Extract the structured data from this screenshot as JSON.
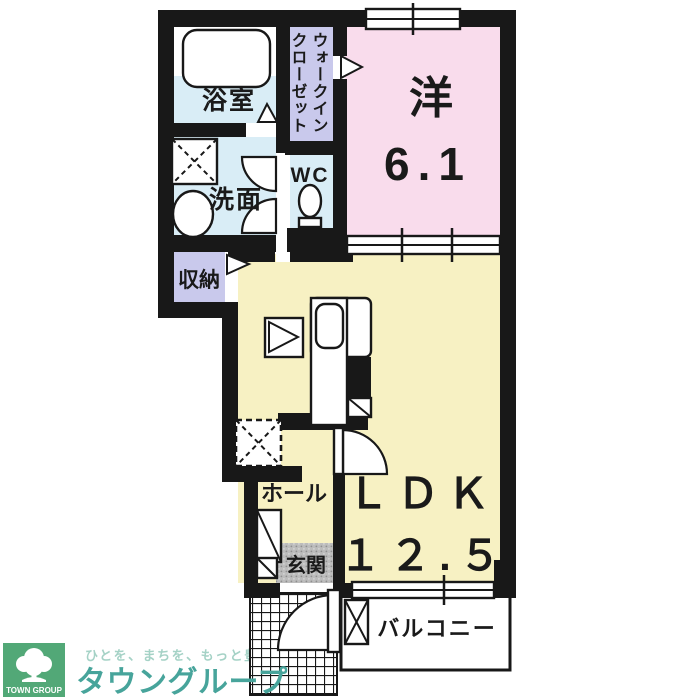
{
  "floorplan": {
    "western_room": {
      "name": "洋",
      "size": "6.1"
    },
    "ldk": {
      "name": "ＬＤＫ",
      "size": "１２.５"
    },
    "bathroom": "浴室",
    "washroom": "洗面",
    "toilet": "WC",
    "walk_in_closet": {
      "line1": "ウォークイン",
      "line2": "クローゼット"
    },
    "storage": "収納",
    "hall": "ホール",
    "entrance": "玄関",
    "balcony": "バルコニー"
  },
  "branding": {
    "logo_text": "TOWN GROUP",
    "tagline": "ひとを、まちを、もっと豊かに",
    "company": "タウングループ"
  },
  "colors": {
    "wall": "#181818",
    "western_room_fill": "#f9dcec",
    "ldk_fill": "#f7f1c3",
    "wet_area_fill": "#d9edf6",
    "closet_fill": "#c9c9ec",
    "entrance_floor": "#bcbcbc",
    "logo_green": "#52a877",
    "logo_teal": "#47a49b",
    "tagline_color": "#a5d2c6"
  }
}
